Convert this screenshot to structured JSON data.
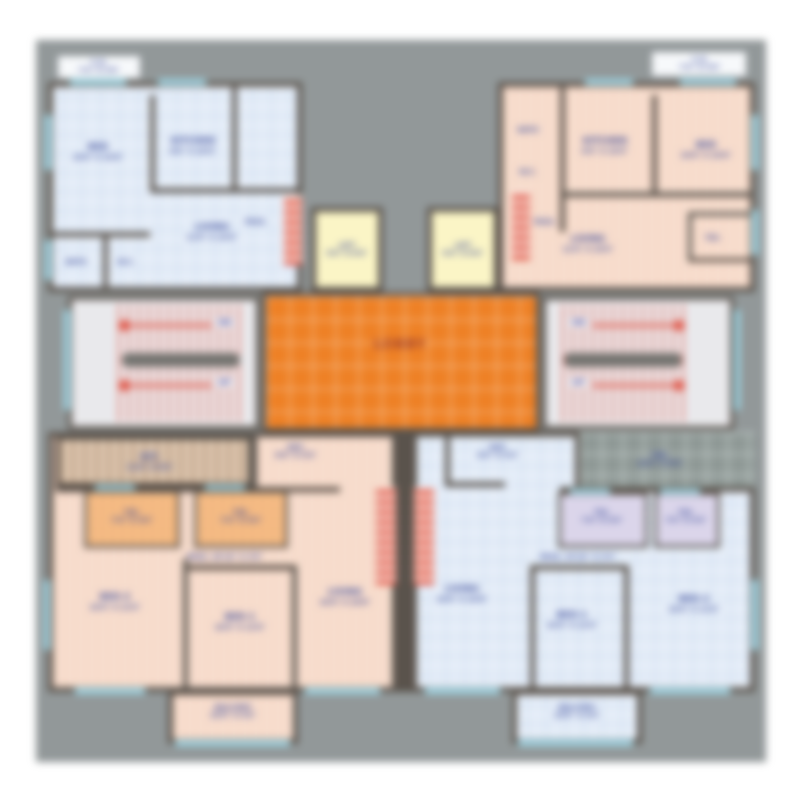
{
  "labels": {
    "tl_bed": {
      "name": "BED",
      "dims": "10'0\" X 10'6\""
    },
    "tl_kitchen": {
      "name": "KITCHEN",
      "dims": "8'0\" X 10'0\""
    },
    "tl_living": {
      "name": "LIVING",
      "dims": "12'6\" X 10'0\""
    },
    "tl_bath": {
      "name": "BATH"
    },
    "tl_wc": {
      "name": "W.C."
    },
    "tl_pass": {
      "name": "PASS."
    },
    "tl_balcony": {
      "name": "C.O.",
      "dims": "7'4\" X 3'0\""
    },
    "tr_kitchen": {
      "name": "KITCHEN",
      "dims": "8'0\" X 10'0\""
    },
    "tr_bed": {
      "name": "BED",
      "dims": "10'0\" X 10'6\""
    },
    "tr_living": {
      "name": "LIVING",
      "dims": "12'6\" X 10'0\""
    },
    "tr_bath": {
      "name": "BATH"
    },
    "tr_wc": {
      "name": "W.C."
    },
    "tr_toi": {
      "name": "TOI."
    },
    "tr_pass": {
      "name": "PASS."
    },
    "tr_balcony": {
      "name": "C.O.",
      "dims": "7'4\" X 3'0\""
    },
    "lift1": {
      "name": "LIFT",
      "dims": "5'0\" X 6'0\""
    },
    "lift2": {
      "name": "LIFT",
      "dims": "5'0\" X 6'0\""
    },
    "lobby": {
      "name": "LOBBY"
    },
    "stair_left": {
      "dn": "DN",
      "up": "UP"
    },
    "stair_right": {
      "dn": "DN",
      "up": "UP"
    },
    "bl_kitchen": {
      "name": "KIT.",
      "dims": "12'0\" X 8'0\""
    },
    "bl_ent": {
      "name": "ENT.",
      "dims": "8'0\" X 5'0\""
    },
    "bl_toi1": {
      "name": "TOI.",
      "dims": "7'0\" X 4'0\""
    },
    "bl_toi2": {
      "name": "TOI.",
      "dims": "7'0\" X 4'0\""
    },
    "bl_pass": {
      "text": "PASS. 29'10\" X 3'6\""
    },
    "bl_bed2": {
      "name": "BED-2",
      "dims": "10'0\" X 12'0\""
    },
    "bl_bed1": {
      "name": "BED-1",
      "dims": "10'0\" X 12'0\""
    },
    "bl_living": {
      "name": "LIVING",
      "dims": "10'0\" X 16'8\""
    },
    "bl_balcony": {
      "name": "BALCONY",
      "dims": "10'6\" X 4'0\""
    },
    "br_ent": {
      "name": "ENT.",
      "dims": "8'0\" X 5'0\""
    },
    "br_terrace": {
      "name": "TER.",
      "dims": "12'0\" X 8'0\""
    },
    "br_toi1": {
      "name": "TOI.",
      "dims": "7'0\" X 4'0\""
    },
    "br_toi2": {
      "name": "TOI.",
      "dims": "7'0\" X 4'0\""
    },
    "br_pass": {
      "text": "PASS. 29'10\" X 3'6\""
    },
    "br_living": {
      "name": "LIVING",
      "dims": "10'0\" X 16'8\""
    },
    "br_bed1": {
      "name": "BED-1",
      "dims": "10'0\" X 12'0\""
    },
    "br_bed2": {
      "name": "BED-2",
      "dims": "10'0\" X 12'0\""
    },
    "br_balcony": {
      "name": "BALCONY",
      "dims": "10'6\" X 4'0\""
    }
  },
  "colors": {
    "lobby": "#ee8126",
    "blue_tile": "#dfe9f6",
    "peach_brick": "#f9e4d6",
    "lift": "#fbf5c6",
    "wall": "#5a534c",
    "window": "#9fd8e8",
    "stair_arrow": "#e05a4a",
    "room_label": "#3c4c9b",
    "lobby_label": "#a23b1e",
    "plan_background": "#929899"
  }
}
